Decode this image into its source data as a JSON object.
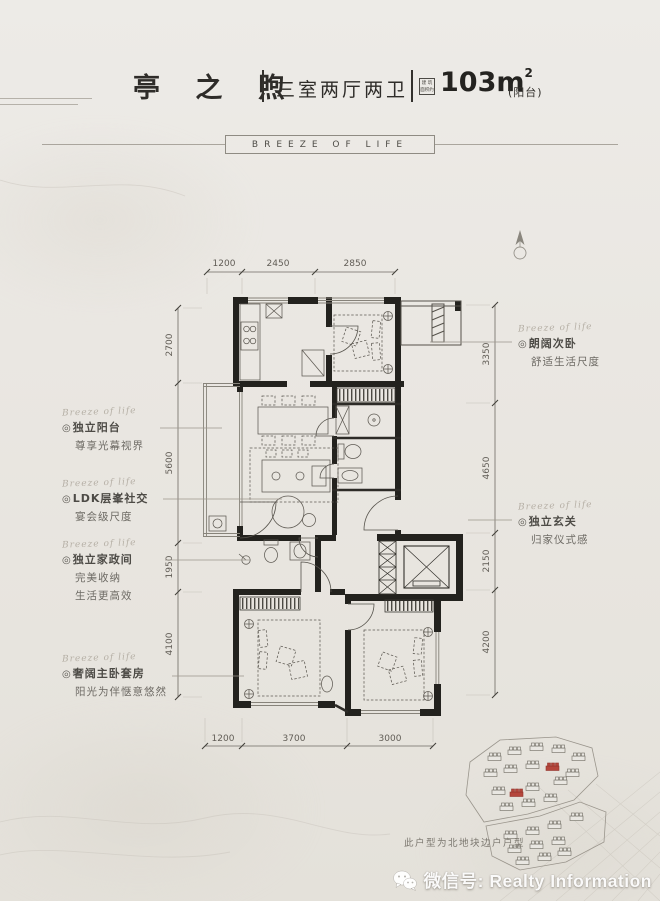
{
  "header": {
    "title": "亭 之 煦",
    "rooms": "三室两厅两卫",
    "area_badge_line1": "建 筑",
    "area_badge_line2": "面积约",
    "area_value": "103m",
    "area_sup": "2",
    "area_note": "(阳台)",
    "banner": "BREEZE OF LIFE"
  },
  "dimensions": {
    "top": [
      "1200",
      "2450",
      "2850"
    ],
    "bottom": [
      "1200",
      "3700",
      "3000"
    ],
    "left": [
      "2700",
      "5600",
      "1950",
      "4100"
    ],
    "right": [
      "3350",
      "4650",
      "2150",
      "4200"
    ]
  },
  "annotations": {
    "bullet": "◎",
    "left": [
      {
        "script": "Breeze of life",
        "title": "独立阳台",
        "lines": [
          "尊享光幕视界"
        ]
      },
      {
        "script": "Breeze of life",
        "title": "LDK层峯社交",
        "lines": [
          "宴会级尺度"
        ]
      },
      {
        "script": "Breeze of life",
        "title": "独立家政间",
        "lines": [
          "完美收纳",
          "生活更高效"
        ]
      },
      {
        "script": "Breeze of life",
        "title": "奢阔主卧套房",
        "lines": [
          "阳光为伴惬意悠然"
        ]
      }
    ],
    "right": [
      {
        "script": "Breeze of life",
        "title": "朗阔次卧",
        "lines": [
          "舒适生活尺度"
        ]
      },
      {
        "script": "Breeze of life",
        "title": "独立玄关",
        "lines": [
          "归家仪式感"
        ]
      }
    ]
  },
  "siteplan": {
    "note": "此户型为北地块边户户型"
  },
  "watermark": {
    "label": "微信号: Realty Information",
    "icon": "wechat-icon"
  }
}
